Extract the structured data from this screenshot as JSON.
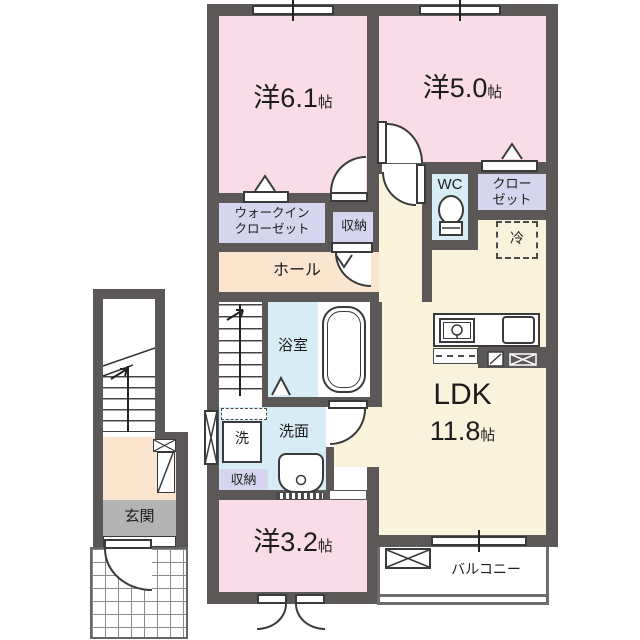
{
  "plan_title": "2F apartment floor plan",
  "colors": {
    "wall": "#5b5857",
    "bedroom_pink": "#fadce8",
    "ldk_cream": "#f8f3da",
    "hall_peach": "#fbe5cf",
    "water_blue": "#d7edf5",
    "closet_lavender": "#d5d5ef",
    "entrance_gray": "#b3b3b3",
    "line": "#3a3a3a"
  },
  "rooms": {
    "bedroom1": {
      "label": "洋6.1",
      "unit": "帖"
    },
    "bedroom2": {
      "label": "洋5.0",
      "unit": "帖"
    },
    "bedroom3": {
      "label": "洋3.2",
      "unit": "帖"
    },
    "ldk": {
      "label": "LDK",
      "size": "11.8",
      "unit": "帖"
    },
    "hall": {
      "label": "ホール"
    },
    "bath": {
      "label": "浴室"
    },
    "washroom": {
      "label": "洗面"
    },
    "washer": {
      "label": "洗"
    },
    "wc": {
      "label": "WC"
    },
    "walkin_closet": {
      "line1": "ウォークイン",
      "line2": "クローゼット"
    },
    "closet": {
      "line1": "クロー",
      "line2": "ゼット"
    },
    "storage_upper": {
      "label": "収納"
    },
    "storage_lower": {
      "label": "収納"
    },
    "fridge": {
      "label": "冷"
    },
    "entrance": {
      "label": "玄関"
    },
    "balcony": {
      "label": "バルコニー"
    }
  }
}
